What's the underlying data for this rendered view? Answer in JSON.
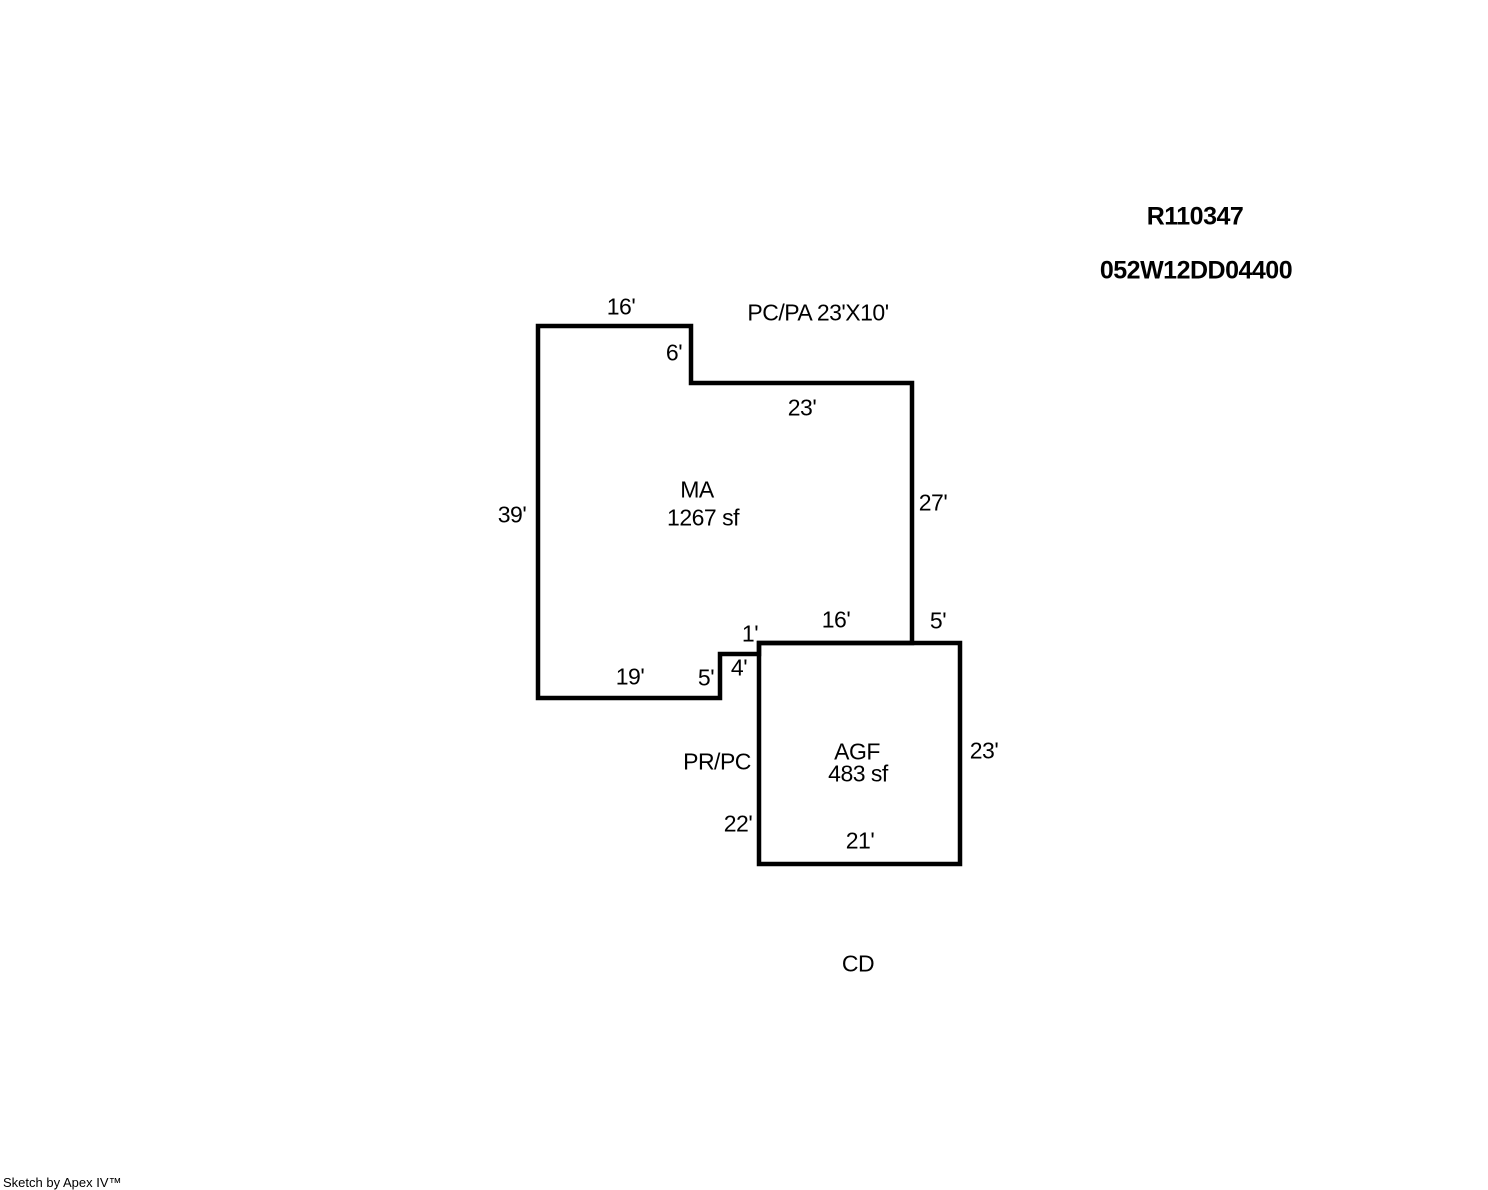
{
  "header": {
    "record_id": "R110347",
    "parcel_id": "052W12DD04400"
  },
  "sketch": {
    "background_color": "#ffffff",
    "line_color": "#000000",
    "areas": {
      "ma": {
        "code": "MA",
        "size": "1267 sf"
      },
      "agf": {
        "code": "AGF",
        "size": "483 sf"
      }
    },
    "annotations": {
      "patio": "PC/PA 23'X10'",
      "porch": "PR/PC",
      "deck": "CD"
    },
    "dimensions": {
      "ma_top": "16'",
      "ma_step_down": "6'",
      "ma_upper_right": "23'",
      "ma_right": "27'",
      "ma_left": "39'",
      "ma_bottom_left": "19'",
      "ma_notch_vertical": "5'",
      "ma_notch_horizontal": "4'",
      "ma_notch_small": "1'",
      "ma_bottom_right": "16'",
      "agf_top_overhang": "5'",
      "agf_right": "23'",
      "agf_left": "22'",
      "agf_bottom": "21'"
    }
  },
  "footer": {
    "credit": "Sketch by Apex IV™"
  }
}
